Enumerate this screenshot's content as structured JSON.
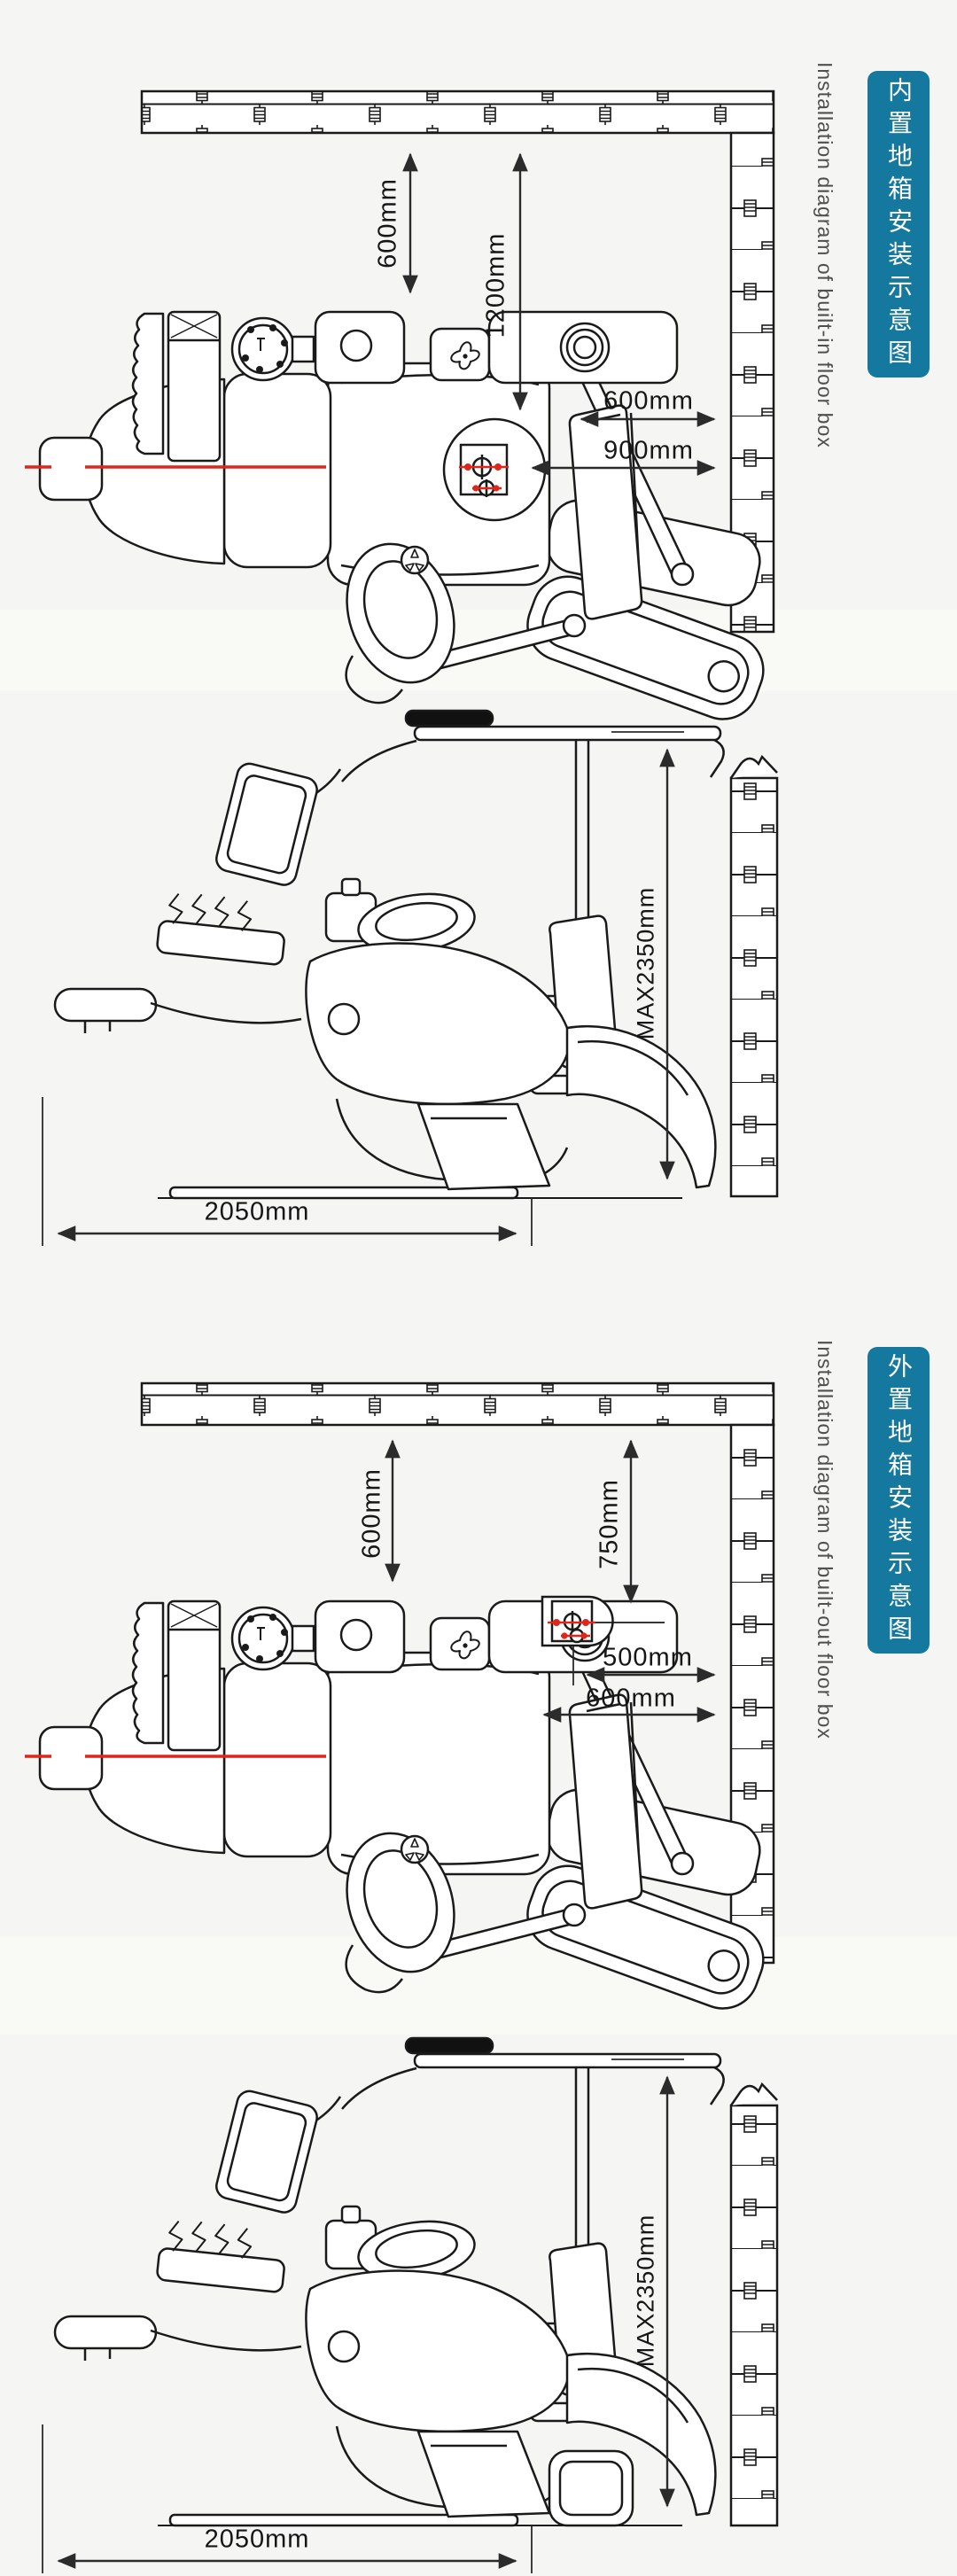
{
  "colors": {
    "accent_teal": "#15789e",
    "centerline_red": "#e0251b",
    "line_black": "#1a1a1a",
    "caption_gray": "#4f4f4f",
    "background": "#f5f5f3"
  },
  "sections": [
    {
      "id": "built-in",
      "badge": "内置地箱安装示意图",
      "caption": "Installation diagram of built-in floor box",
      "top_view": {
        "wall_clearance_vertical": "600mm",
        "floorbox_depth_vertical": "1200mm",
        "wall_clearance_horizontal": "600mm",
        "floorbox_to_wall_horizontal": "900mm"
      },
      "side_view": {
        "max_height": "MAX2350mm",
        "length": "2050mm"
      }
    },
    {
      "id": "built-out",
      "badge": "外置地箱安装示意图",
      "caption": "Installation diagram of built-out floor box",
      "top_view": {
        "wall_clearance_vertical": "600mm",
        "floorbox_depth_vertical": "750mm",
        "floorbox_to_wall_horizontal": "500mm",
        "wall_clearance_horizontal": "600mm"
      },
      "side_view": {
        "max_height": "MAX2350mm",
        "length": "2050mm"
      }
    }
  ]
}
